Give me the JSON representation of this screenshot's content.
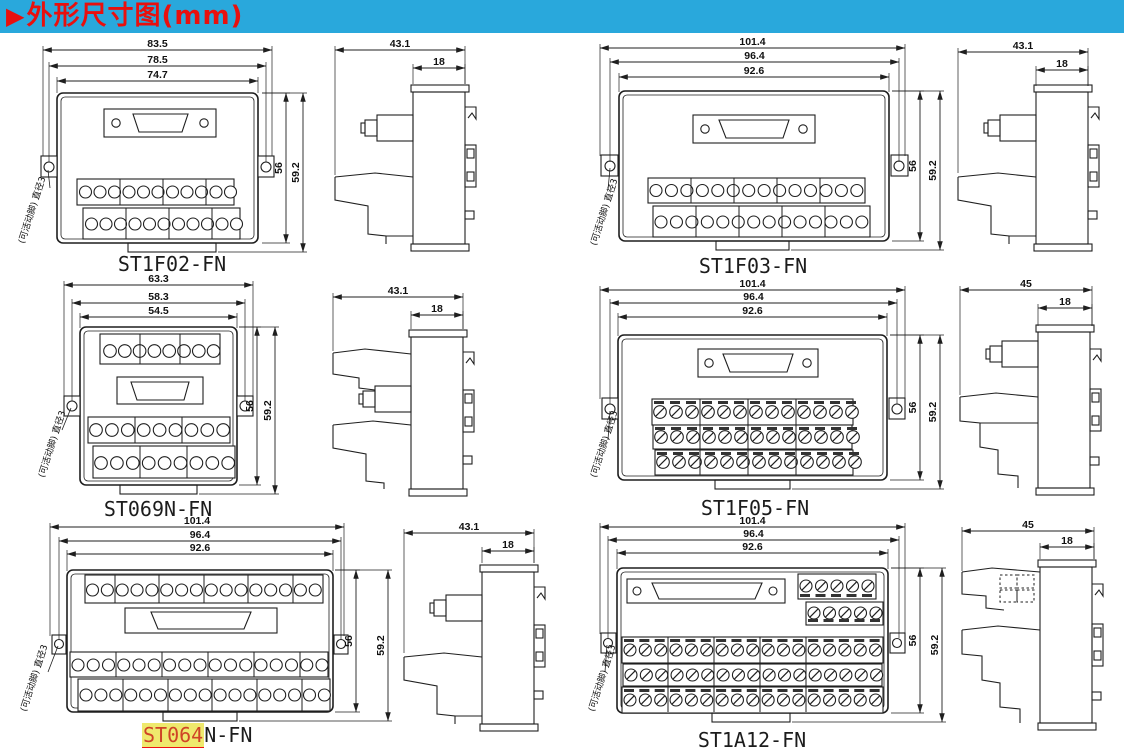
{
  "header": {
    "arrow": "▶",
    "title": "外形尺寸图(mm)"
  },
  "note": "(可活动脚) 直径3",
  "colors": {
    "banner_bg": "#29a8dc",
    "banner_text": "#e8100e",
    "highlight_bg": "#efe96d",
    "highlight_text": "#cf4426",
    "line": "#1f1f1f"
  },
  "modules": [
    {
      "name": "ST1F02-FN",
      "front": {
        "width_overall": "83.5",
        "width_holes": "78.5",
        "width_body": "74.7",
        "height_body": "56",
        "height_overall": "59.2"
      },
      "side": {
        "depth": "43.1",
        "rail_depth": "18"
      }
    },
    {
      "name": "ST1F03-FN",
      "front": {
        "width_overall": "101.4",
        "width_holes": "96.4",
        "width_body": "92.6",
        "height_body": "56",
        "height_overall": "59.2"
      },
      "side": {
        "depth": "43.1",
        "rail_depth": "18"
      }
    },
    {
      "name": "ST069N-FN",
      "front": {
        "width_overall": "63.3",
        "width_holes": "58.3",
        "width_body": "54.5",
        "height_body": "56",
        "height_overall": "59.2"
      },
      "side": {
        "depth": "43.1",
        "rail_depth": "18"
      }
    },
    {
      "name": "ST1F05-FN",
      "front": {
        "width_overall": "101.4",
        "width_holes": "96.4",
        "width_body": "92.6",
        "height_body": "56",
        "height_overall": "59.2"
      },
      "side": {
        "depth": "45",
        "rail_depth": "18"
      }
    },
    {
      "name": "ST064N-FN",
      "name_parts": {
        "highlighted": "ST064",
        "rest": "N-FN"
      },
      "front": {
        "width_overall": "101.4",
        "width_holes": "96.4",
        "width_body": "92.6",
        "height_body": "56",
        "height_overall": "59.2"
      },
      "side": {
        "depth": "43.1",
        "rail_depth": "18"
      }
    },
    {
      "name": "ST1A12-FN",
      "front": {
        "width_overall": "101.4",
        "width_holes": "96.4",
        "width_body": "92.6",
        "height_body": "56",
        "height_overall": "59.2"
      },
      "side": {
        "depth": "45",
        "rail_depth": "18"
      }
    }
  ]
}
